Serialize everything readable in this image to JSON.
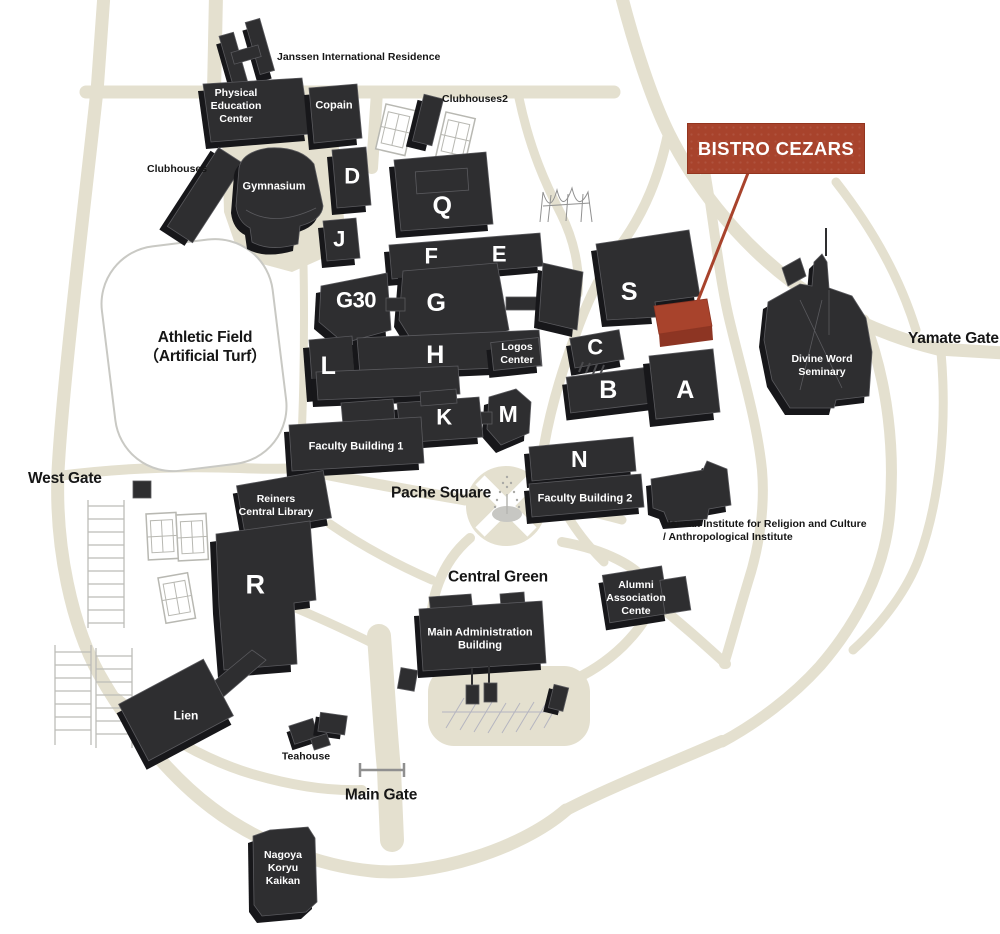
{
  "banner": {
    "label": "BISTRO CEZARS",
    "color": "#a8432c"
  },
  "gates": {
    "west": "West Gate",
    "yamate": "Yamate Gate",
    "main": "Main Gate"
  },
  "areas": {
    "athletic_field": "Athletic Field\n（Artificial Turf）",
    "pache_square": "Pache Square",
    "central_green": "Central Green"
  },
  "buildings": {
    "janssen": "Janssen International Residence",
    "physical_education_center": "Physical\nEducation\nCenter",
    "copain": "Copain",
    "clubhouses2": "Clubhouses2",
    "clubhouses": "Clubhouses",
    "gymnasium": "Gymnasium",
    "d": "D",
    "j": "J",
    "q": "Q",
    "f": "F",
    "e": "E",
    "s": "S",
    "g30": "G30",
    "g": "G",
    "l": "L",
    "h": "H",
    "logos_center": "Logos\nCenter",
    "c": "C",
    "b": "B",
    "a": "A",
    "k": "K",
    "m": "M",
    "n": "N",
    "faculty_building_1": "Faculty Building 1",
    "faculty_building_2": "Faculty Building 2",
    "reiners_central_library": "Reiners\nCentral Library",
    "r": "R",
    "divine_word_seminary": "Divine Word\nSeminary",
    "nanzan_institute": "Nanzan Institute for Religion and Culture\n/ Anthropological Institute",
    "alumni_association_center": "Alumni\nAssociation\nCente",
    "main_administration_building": "Main Administration\nBuilding",
    "lien": "Lien",
    "teahouse": "Teahouse",
    "nagoya_koryu_kaikan": "Nagoya\nKoryu\nKaikan"
  },
  "colors": {
    "road": "#e4e0cf",
    "building": "#2e2e30",
    "highlight": "#a8432c"
  }
}
